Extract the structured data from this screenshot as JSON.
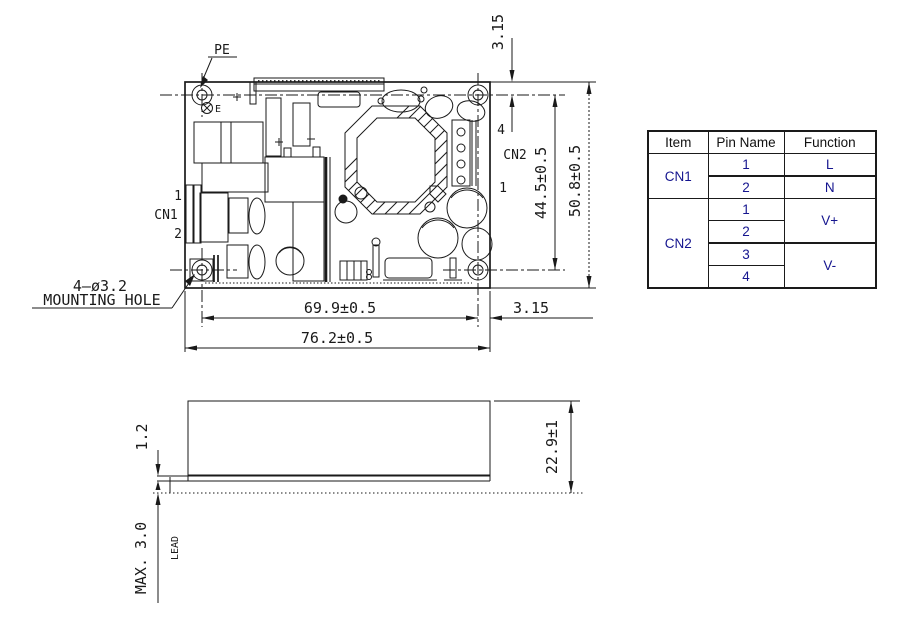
{
  "drawing": {
    "pe_label": "PE",
    "earth_label": "E",
    "cn1": {
      "label": "CN1",
      "pin_top": "1",
      "pin_bottom": "2"
    },
    "cn2": {
      "label": "CN2",
      "pin_top": "4",
      "pin_bottom": "1"
    },
    "mounting_hole_note_line1": "4—ø3.2",
    "mounting_hole_note_line2": "MOUNTING HOLE",
    "dimensions": {
      "hole_edge_offset_top": "3.15",
      "hole_pitch_vertical": "44.5±0.5",
      "board_height": "50.8±0.5",
      "hole_pitch_horizontal": "69.9±0.5",
      "board_width": "76.2±0.5",
      "hole_edge_offset_right": "3.15"
    }
  },
  "side_view": {
    "pcb_thickness": "1.2",
    "overall_height": "22.9±1",
    "lead_max_length": "MAX. 3.0",
    "lead_label": "LEAD"
  },
  "pin_table": {
    "headers": {
      "item": "Item",
      "pin_name": "Pin Name",
      "function": "Function"
    },
    "cn1": {
      "item": "CN1",
      "pin_1": "1",
      "pin_2": "2",
      "function_1": "L",
      "function_2": "N"
    },
    "cn2": {
      "item": "CN2",
      "pin_1": "1",
      "pin_2": "2",
      "pin_3": "3",
      "pin_4": "4",
      "function_12": "V+",
      "function_34": "V-"
    }
  },
  "colors": {
    "line": "#1a1a1a",
    "table_text": "#15158f",
    "background": "#ffffff"
  }
}
